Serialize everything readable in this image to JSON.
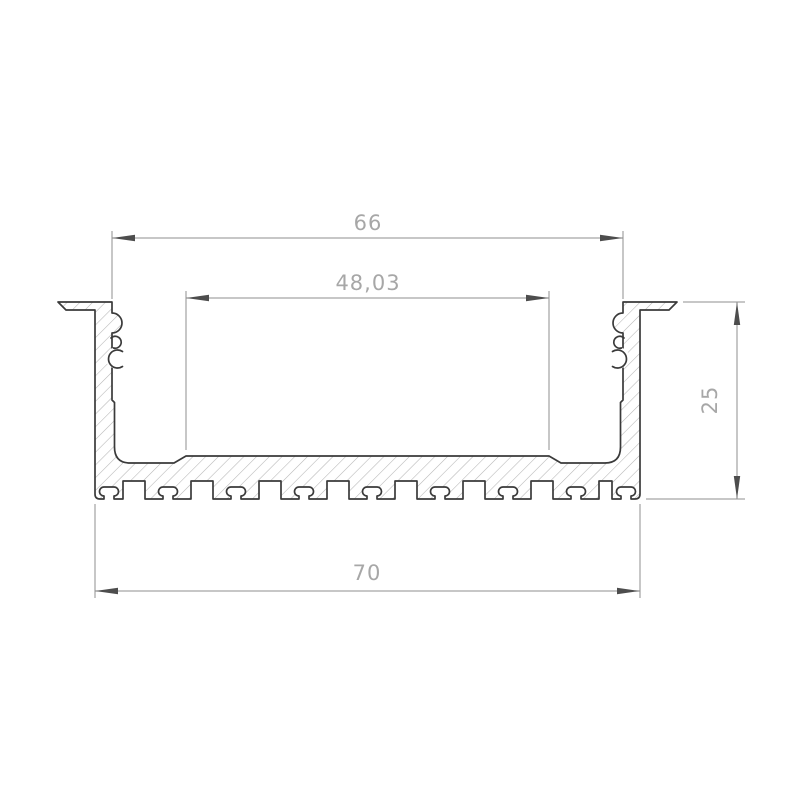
{
  "drawing": {
    "kind": "technical cross-section drawing",
    "dimensions": {
      "outer_width": {
        "label": "66"
      },
      "inner_width": {
        "label": "48,03"
      },
      "base_width": {
        "label": "70"
      },
      "height": {
        "label": "25"
      }
    },
    "colors": {
      "background": "#ffffff",
      "outline": "#3a3a3a",
      "hatch": "#b5b5b5",
      "dimension_line": "#8f8f8f",
      "dimension_text": "#a7a7a7",
      "arrow": "#4d4d4d"
    }
  }
}
